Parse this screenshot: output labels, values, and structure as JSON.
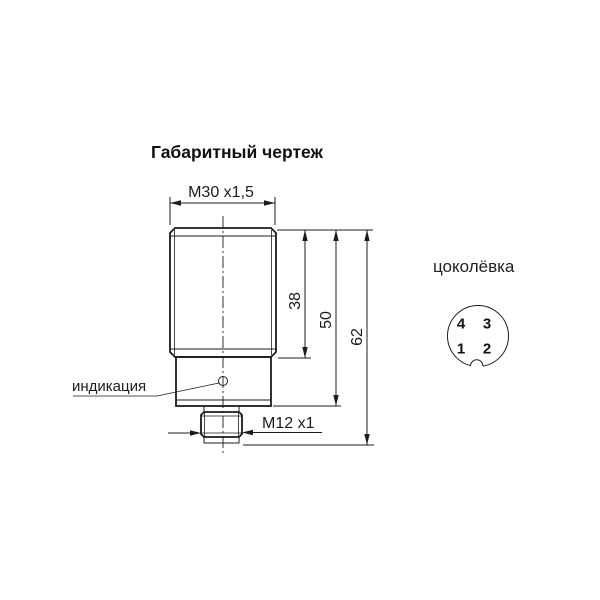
{
  "page": {
    "background": "#ffffff",
    "line_color": "#1c1c1c"
  },
  "drawing": {
    "title": "Габаритный чертеж",
    "labels": {
      "thread_top": "M30 x1,5",
      "thread_connector": "M12 x1",
      "indication": "индикация"
    },
    "dimensions": {
      "body_length": "38",
      "housing_length": "50",
      "total_length": "62"
    }
  },
  "pinout": {
    "title": "цоколёвка",
    "pins": [
      {
        "number": "4"
      },
      {
        "number": "3"
      },
      {
        "number": "1"
      },
      {
        "number": "2"
      }
    ]
  }
}
